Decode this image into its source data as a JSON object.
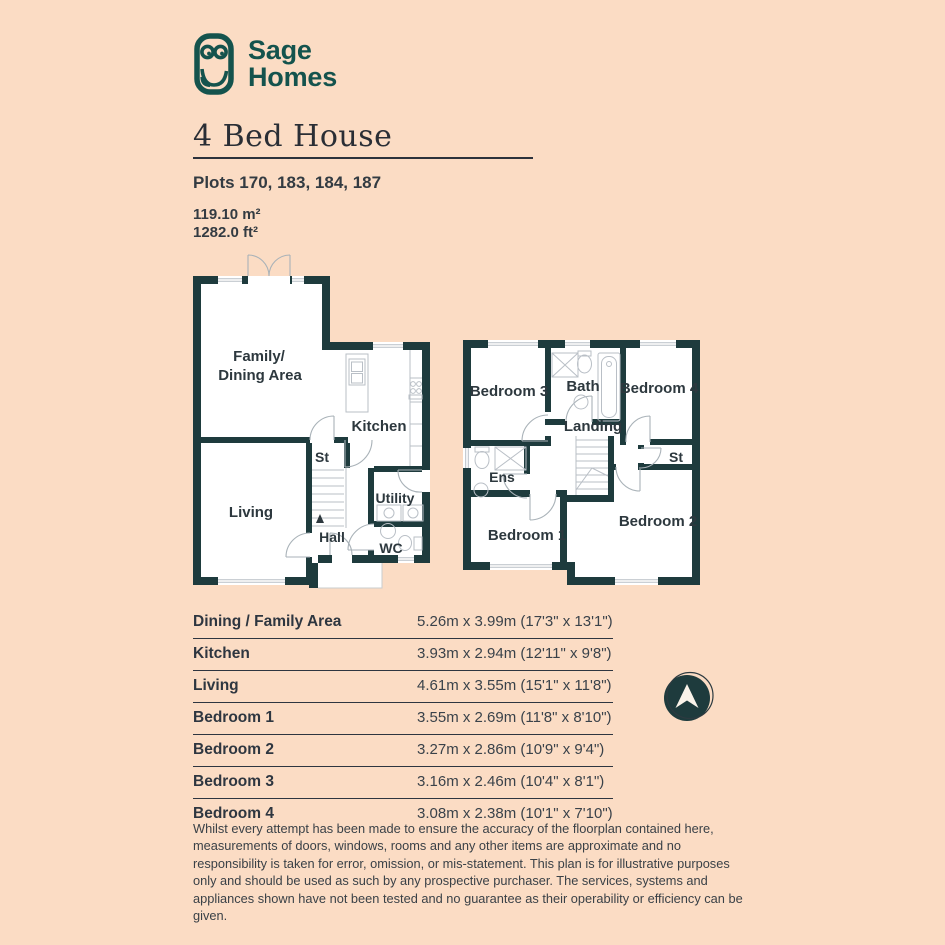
{
  "colors": {
    "background": "#fbdcc4",
    "wall": "#1e3b3d",
    "brand_teal": "#14534d",
    "text_dark": "#333b42",
    "fixture_gray": "#b9bfc6",
    "door_arc_gray": "#a9b2b8"
  },
  "brand": {
    "line1": "Sage",
    "line2": "Homes"
  },
  "header": {
    "title": "4 Bed House",
    "plots": "Plots 170, 183, 184, 187",
    "area_metric": "119.10 m²",
    "area_imperial": "1282.0 ft²"
  },
  "floorplan": {
    "ground_floor": {
      "family_line1": "Family/",
      "family_line2": "Dining Area",
      "kitchen": "Kitchen",
      "st": "St",
      "living": "Living",
      "utility": "Utility",
      "hall": "Hall",
      "wc": "WC"
    },
    "first_floor": {
      "bedroom3": "Bedroom 3",
      "bath": "Bath",
      "bedroom4": "Bedroom 4",
      "landing": "Landing",
      "ens": "Ens",
      "st": "St",
      "bedroom1": "Bedroom 1",
      "bedroom2": "Bedroom 2"
    }
  },
  "dimensions_table": {
    "rows": [
      {
        "room": "Dining / Family Area",
        "size": "5.26m x 3.99m (17'3\" x 13'1\")"
      },
      {
        "room": "Kitchen",
        "size": "3.93m x 2.94m (12'11\" x 9'8\")"
      },
      {
        "room": "Living",
        "size": "4.61m x 3.55m (15'1\" x 11'8\")"
      },
      {
        "room": "Bedroom 1",
        "size": "3.55m x 2.69m (11'8\" x 8'10\")"
      },
      {
        "room": "Bedroom 2",
        "size": "3.27m x 2.86m (10'9\" x 9'4\")"
      },
      {
        "room": "Bedroom 3",
        "size": "3.16m x 2.46m (10'4\" x 8'1\")"
      },
      {
        "room": "Bedroom 4",
        "size": "3.08m x 2.38m (10'1\" x 7'10\")"
      }
    ]
  },
  "disclaimer": "Whilst every attempt has been made to ensure the accuracy of the floorplan contained here, measurements of doors, windows, rooms and any other items are approximate and no responsibility is taken for error, omission, or mis-statement. This plan is for illustrative purposes only and should be used as such by any prospective purchaser. The services, systems and appliances shown have not been tested and no guarantee as their operability or efficiency can be given."
}
